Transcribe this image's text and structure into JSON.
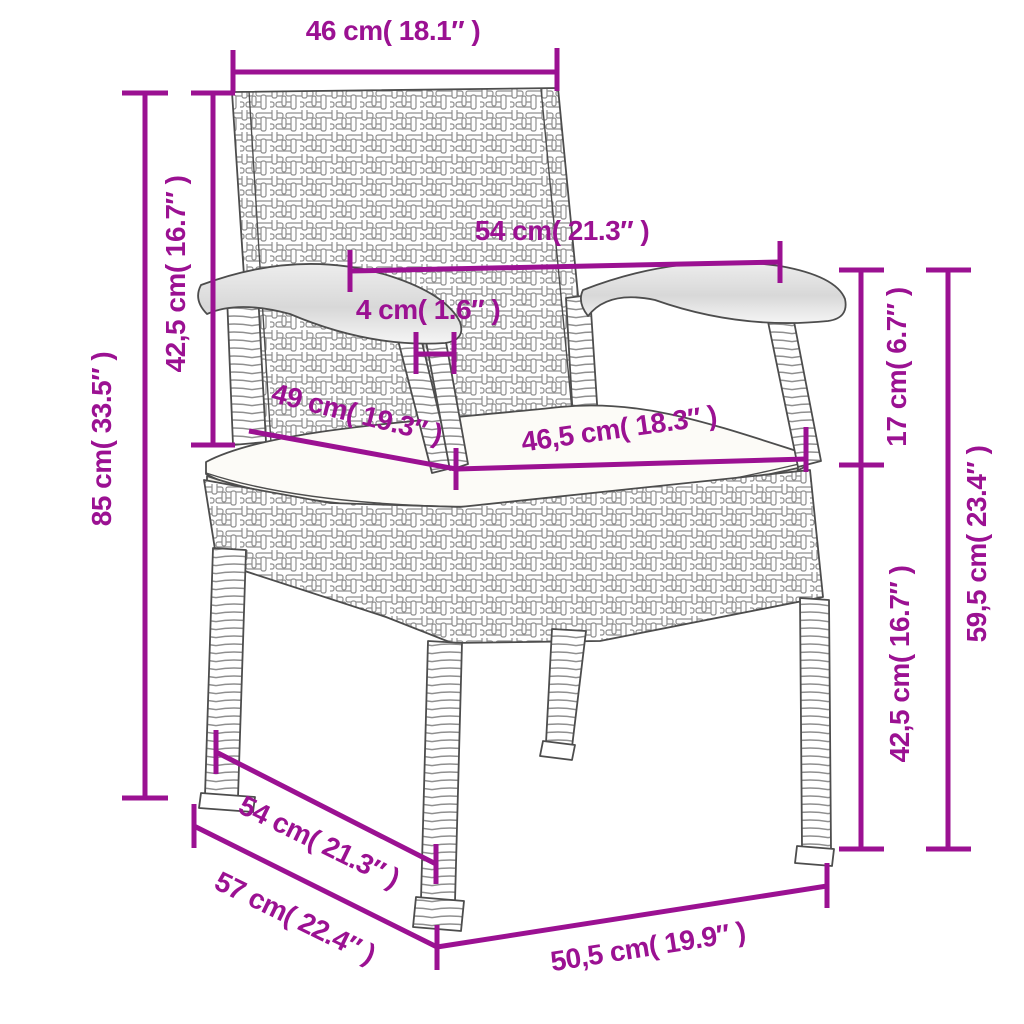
{
  "diagram": {
    "subject": "wicker garden armchair line drawing with seat cushion",
    "accent_color": "#9B1192",
    "dimensions": {
      "backrest_width": {
        "label": "46 cm( 18.1″ )",
        "cm": "46",
        "inch": "18.1"
      },
      "backrest_height": {
        "label": "42,5 cm( 16.7″ )",
        "cm": "42,5",
        "inch": "16.7"
      },
      "total_height": {
        "label": "85 cm( 33.5″ )",
        "cm": "85",
        "inch": "33.5"
      },
      "armrest_span": {
        "label": "54 cm( 21.3″ )",
        "cm": "54",
        "inch": "21.3"
      },
      "armrest_thickness": {
        "label": "4 cm( 1.6″ )",
        "cm": "4",
        "inch": "1.6"
      },
      "seat_depth": {
        "label": "49 cm( 19.3″ )",
        "cm": "49",
        "inch": "19.3"
      },
      "seat_width": {
        "label": "46,5 cm( 18.3″ )",
        "cm": "46,5",
        "inch": "18.3"
      },
      "armrest_above_seat": {
        "label": "17 cm( 6.7″ )",
        "cm": "17",
        "inch": "6.7"
      },
      "armrest_height": {
        "label": "59,5 cm( 23.4″ )",
        "cm": "59,5",
        "inch": "23.4"
      },
      "seat_height": {
        "label": "42,5 cm( 16.7″ )",
        "cm": "42,5",
        "inch": "16.7"
      },
      "seat_depth_outer": {
        "label": "54 cm( 21.3″ )",
        "cm": "54",
        "inch": "21.3"
      },
      "total_depth": {
        "label": "57 cm( 22.4″ )",
        "cm": "57",
        "inch": "22.4"
      },
      "base_width": {
        "label": "50,5 cm( 19.9″ )",
        "cm": "50,5",
        "inch": "19.9"
      }
    }
  }
}
